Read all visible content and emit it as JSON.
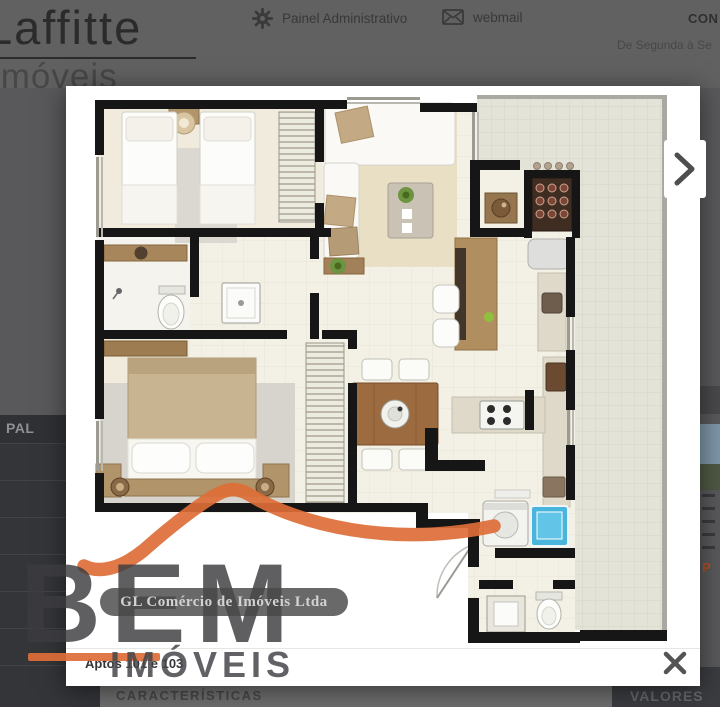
{
  "header": {
    "logo_line1": "Laffitte",
    "logo_line2": "imóveis",
    "admin_label": "Painel Administrativo",
    "webmail_label": "webmail",
    "contact_label": "CON",
    "schedule_label": "De Segunda à Se"
  },
  "sidebar": {
    "visible_item_label": "PAL"
  },
  "page_background": {
    "section_characteristics": "CARACTERÍSTICAS",
    "section_values": "VALORES",
    "partial_orange_text": "P"
  },
  "lightbox": {
    "caption": "Aptos 101 e 103"
  },
  "watermark": {
    "brand_top": "BEM",
    "brand_bottom": "IMÓVEIS",
    "company": "GL Comércio de Imóveis Ltda",
    "accent_color": "#dd6e37"
  },
  "icons": {
    "admin": "gear",
    "webmail": "envelope",
    "next": "chevron-right",
    "close": "close-x"
  },
  "floorplan": {
    "palette": {
      "wall": "#161616",
      "floor_tile": "#f3f0e5",
      "bedroom_floor": "#f0ebdc",
      "carpet": "#e8dfc5",
      "terrace_tile": "#e3e3d8",
      "wood": "#b2946a",
      "table_wood": "#9c6b3f",
      "counter_granite": "#ded9c9",
      "laundry_tank_blue": "#4ab5dc",
      "plant_green": "#6d9440"
    }
  }
}
